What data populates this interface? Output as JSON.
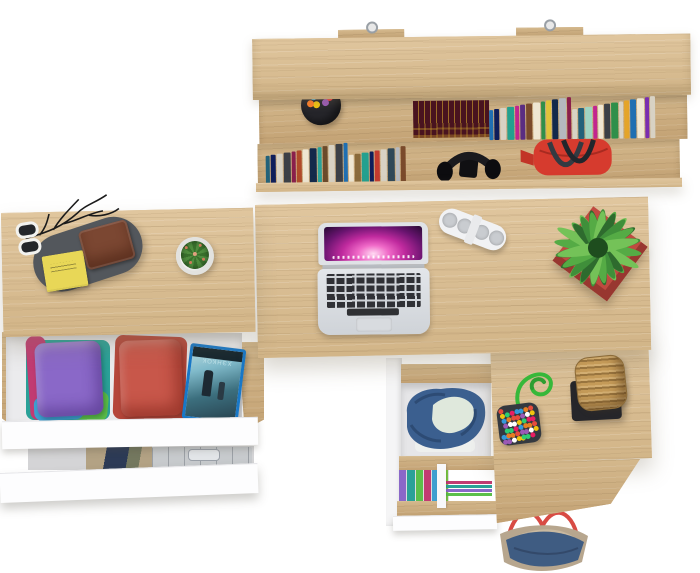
{
  "meta": {
    "description": "Top-down product photo of an oak home-office set: wall shelf with books, main desk with laptop, side desk with open clothing drawers, drawer pedestal with decor and a tote bag underneath",
    "background": "#ffffff"
  },
  "palette": {
    "wood": "#d8bd92",
    "wood_dark": "#cbad80",
    "panel_white": "#fdfdfe"
  },
  "shelf": {
    "books_top": [
      "#1f6fb2",
      "#0e1e5b",
      "#d8d2c4",
      "#23a08f",
      "#c2258f",
      "#5a2d82",
      "#7a4a2b",
      "#efe6d2",
      "#2f8f4a",
      "#e0c23a",
      "#13294b",
      "#b5b9bf",
      "#8a1f4b",
      "#d8d2c4",
      "#23627a",
      "#a0d4c2",
      "#c2258f",
      "#efe6d2",
      "#3b3f46",
      "#2f8f4a",
      "#d8d2c4",
      "#e4a42a",
      "#1f6fb2",
      "#efe6d2",
      "#7a2db0",
      "#d8d2c4"
    ],
    "books_bottom": [
      "#23627a",
      "#0e1e5b",
      "#d8d2c4",
      "#3b3f46",
      "#8a1f4b",
      "#b04a2a",
      "#efe6d2",
      "#13294b",
      "#2aa198",
      "#6b4a2b",
      "#d8d2c4",
      "#3b3f46",
      "#1f6fb2",
      "#efe6d2",
      "#8a6a3b",
      "#23a08f",
      "#0e1e5b",
      "#c23b2f",
      "#d8d2c4",
      "#2f4858",
      "#b5b9bf",
      "#7a4a2b"
    ],
    "book_set": {
      "cover": "#49131f",
      "trim": "#d2a62c"
    },
    "pen_cup": {
      "cup": "#26262b",
      "pens": [
        "#2aa0d8",
        "#3cb44b",
        "#e23b3b",
        "#f1c40f",
        "#9b59b6",
        "#ff7f27"
      ]
    },
    "duffel_bag": {
      "body": "#d63b2e",
      "handles": "#2f343c"
    },
    "headphones": "#141417"
  },
  "desk": {
    "laptop": {
      "body": "#dfe2e6",
      "keys": "#2f3033",
      "wallpaper": [
        "#ffd9f2",
        "#f06ac8",
        "#c02a9e",
        "#6a1470",
        "#260a33"
      ]
    },
    "speaker": {
      "body": "#f1f2f4",
      "grille": "#c9ccd0"
    },
    "plant": {
      "pot": "#bf4a40",
      "leaf_colors": [
        "#2e6b2e",
        "#3f8f3a",
        "#55ab45",
        "#74c258"
      ]
    },
    "valet_tray": {
      "tray": "#53575c",
      "notepad": "#e8d757",
      "wallet": "#7b4732",
      "glasses": "#f2f2ef"
    },
    "cactus": {
      "pot": "#f3f3f1",
      "body": "#4c8a3f",
      "spines": "#cd7a5a"
    },
    "branch": "#1b1b1b"
  },
  "drawers": {
    "left_top": {
      "pile_layers": [
        "#2aa198",
        "#c13b72",
        "#5bbf4a",
        "#3e9fd0"
      ],
      "pile_top": "#8a68c8",
      "red_stack_base": "#b5463a",
      "red_stack_top": "#c8574a",
      "dvd": {
        "title": "ХЭНКОК",
        "case": "#1878c8",
        "cover_dark": "#27414e",
        "cover_light": "#bfe3ea"
      }
    },
    "left_lower": {
      "clothes": [
        "#b3a284",
        "#2c3a56",
        "#74785f"
      ],
      "case": "#c7cacd"
    },
    "middle_top": {
      "denim": "#3b5f8f",
      "denim_fold": "#2d4b74",
      "cloth_mint": "#dfe8dc",
      "cloth_white": "#eef0ee"
    },
    "middle_lower": [
      "#8a68c8",
      "#2aa198",
      "#5bbf4a",
      "#c13b72",
      "#3e9fd0",
      "#7ac943"
    ],
    "middle_lower_right": [
      "#c13b72",
      "#2aa198",
      "#8a68c8",
      "#5bbf4a"
    ]
  },
  "pedestal": {
    "beads": {
      "base": "#343940",
      "cord": "#37b83a",
      "palette": [
        "#e74c3c",
        "#f1c40f",
        "#3498db",
        "#9b59b6",
        "#2ecc71",
        "#e67e22",
        "#ffffff",
        "#e91e63"
      ]
    },
    "basket": {
      "wicker": "#c49a58",
      "stand": "#26262a"
    },
    "tote_bag": {
      "canvas": "#b7a68e",
      "denim": "#3f5c82",
      "handles": "#d84b44",
      "lining": "#c9b9a0"
    }
  }
}
